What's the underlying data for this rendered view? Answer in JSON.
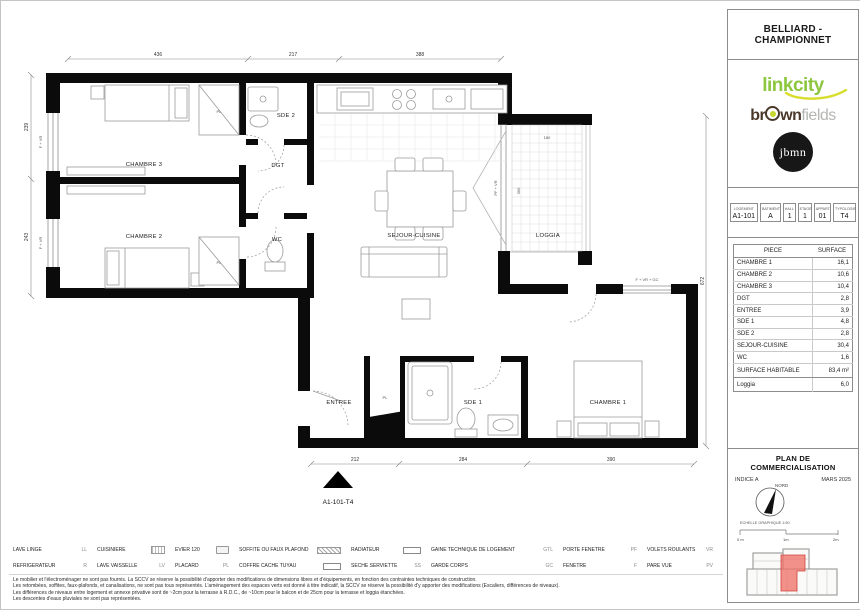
{
  "sheet": {
    "project_title": "BELLIARD - CHAMPIONNET",
    "plan_title": "PLAN DE COMMERCIALISATION",
    "indice": "INDICE A",
    "date": "MARS 2025",
    "north_label": "NORD",
    "scale_label": "ECHELLE GRAPHIQUE 1:50",
    "scale_ticks": [
      "0 m",
      "1m",
      "2m"
    ]
  },
  "logos": {
    "linkcity": "linkcity",
    "brown_left": "br",
    "brown_right": "wn",
    "fields": "fields",
    "jbmn": "jbmn"
  },
  "unit_info": {
    "columns": [
      {
        "header": "LOGEMENT",
        "value": "A1-101"
      },
      {
        "header": "BATIMENT",
        "value": "A"
      },
      {
        "header": "HALL",
        "value": "1"
      },
      {
        "header": "ETAGE",
        "value": "1"
      },
      {
        "header": "APPART.",
        "value": "01"
      },
      {
        "header": "TYPOLOGIE",
        "value": "T4"
      }
    ]
  },
  "surfaces": {
    "col_piece": "PIECE",
    "col_surface": "SURFACE",
    "rows": [
      {
        "piece": "CHAMBRE 1",
        "surface": "16,1"
      },
      {
        "piece": "CHAMBRE 2",
        "surface": "10,6"
      },
      {
        "piece": "CHAMBRE 3",
        "surface": "10,4"
      },
      {
        "piece": "DGT",
        "surface": "2,8"
      },
      {
        "piece": "ENTREE",
        "surface": "3,9"
      },
      {
        "piece": "SDE 1",
        "surface": "4,8"
      },
      {
        "piece": "SDE 2",
        "surface": "2,8"
      },
      {
        "piece": "SEJOUR-CUISINE",
        "surface": "30,4"
      },
      {
        "piece": "WC",
        "surface": "1,6"
      }
    ],
    "total": {
      "piece": "SURFACE HABITABLE",
      "surface": "83,4 m²"
    },
    "annex": {
      "piece": "Loggia",
      "surface": "6,0"
    }
  },
  "floorplan": {
    "unit_label": "A1-101-T4",
    "rooms": {
      "chambre3": "CHAMBRE 3",
      "chambre2": "CHAMBRE 2",
      "sde2": "SDE 2",
      "dgt": "DGT",
      "wc": "WC",
      "sejour": "SEJOUR-CUISINE",
      "loggia": "LOGGIA",
      "entree": "ENTREE",
      "sde1": "SDE 1",
      "chambre1": "CHAMBRE 1"
    },
    "labels": {
      "pl": "PL",
      "window_chambre1": "F + VR + GC",
      "window_left": "F + VR",
      "window_loggia": "PF + VR"
    },
    "dims": {
      "top": [
        "436",
        "217",
        "388"
      ],
      "bottom": [
        "212",
        "284",
        "390"
      ],
      "right": "672",
      "left": [
        "239",
        "243"
      ],
      "loggia_w": "180",
      "loggia_h": "360"
    }
  },
  "legend": {
    "items": [
      {
        "label": "LAVE LINGE",
        "code": "LL",
        "icon": ""
      },
      {
        "label": "CUISINIERE",
        "code": "",
        "icon": "stove-icon"
      },
      {
        "label": "EVIER 120",
        "code": "",
        "icon": "sink-icon"
      },
      {
        "label": "SOFFITE OU FAUX PLAFOND",
        "code": "",
        "icon": "hatched-soffit-icon"
      },
      {
        "label": "RADIATEUR",
        "code": "",
        "icon": "radiator-box-icon"
      },
      {
        "label": "GAINE TECHNIQUE DE LOGEMENT",
        "code": "GTL",
        "icon": ""
      },
      {
        "label": "PORTE FENETRE",
        "code": "PF",
        "icon": ""
      },
      {
        "label": "VOLETS ROULANTS",
        "code": "VR",
        "icon": ""
      },
      {
        "label": "REFRIGERATEUR",
        "code": "R",
        "icon": ""
      },
      {
        "label": "LAVE VAISSELLE",
        "code": "LV",
        "icon": ""
      },
      {
        "label": "PLACARD",
        "code": "PL",
        "icon": ""
      },
      {
        "label": "COFFRE CACHE TUYAU",
        "code": "",
        "icon": "pipe-box-icon"
      },
      {
        "label": "SECHE SERVIETTE",
        "code": "SS",
        "icon": ""
      },
      {
        "label": "GARDE CORPS",
        "code": "GC",
        "icon": ""
      },
      {
        "label": "FENETRE",
        "code": "F",
        "icon": ""
      },
      {
        "label": "PARE VUE",
        "code": "PV",
        "icon": ""
      }
    ]
  },
  "footnotes": [
    "Le mobilier et l'électroménager ne sont pas fournis. La SCCV se réserve la possibilité d'apporter des modifications de dimensions libres et d'équipements, en fonction des contraintes techniques de construction.",
    "Les retombées, soffites, faux-plafonds, et canalisations, ne sont pas tous représentés. L'aménagement des espaces verts est donné à titre indicatif, la SCCV se réserve la possibilité d'y apporter des modifications (Escaliers, différences de niveaux).",
    "Les différences de niveaux entre logement et annexe privative sont de ~2cm pour la terrasse à R.D.C., de ~10cm pour le balcon et de 25cm pour la terrasse et loggia étanchées.",
    "Les descentes d'eaux pluviales ne sont pas représentées."
  ]
}
